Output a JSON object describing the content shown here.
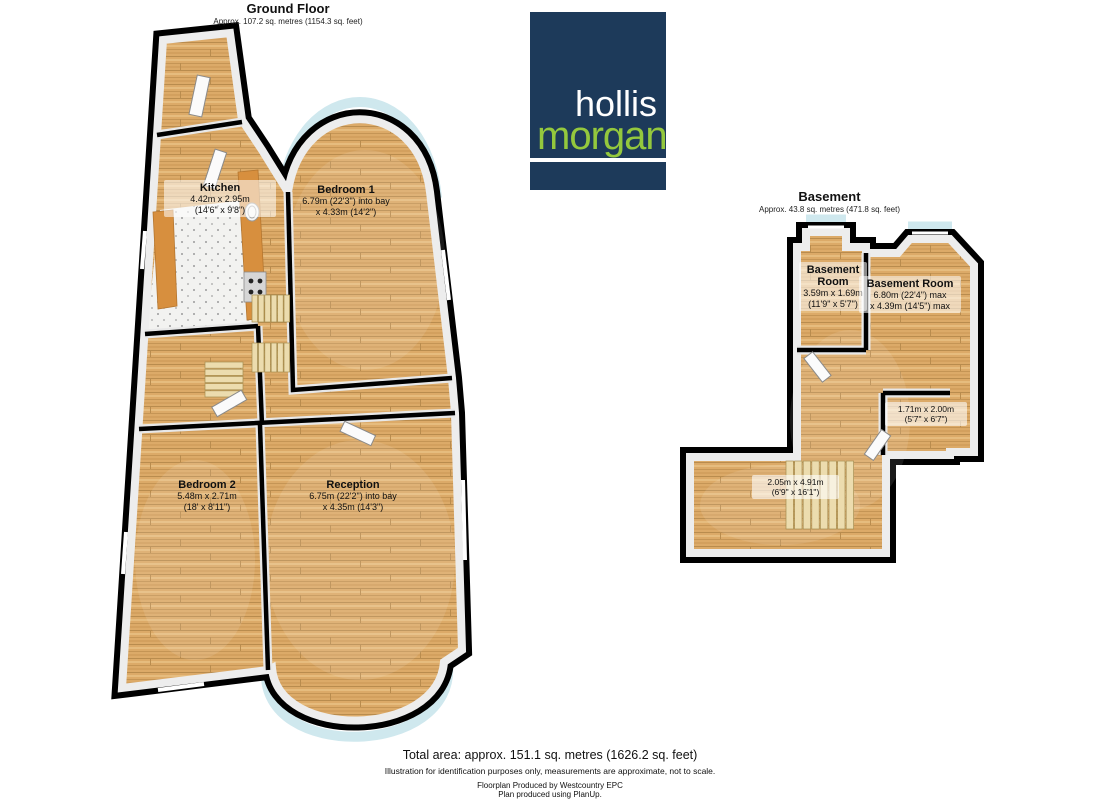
{
  "ground_floor": {
    "title": "Ground Floor",
    "subtitle": "Approx. 107.2 sq. metres (1154.3 sq. feet)",
    "rooms": {
      "kitchen": {
        "name": "Kitchen",
        "metric": "4.42m x 2.95m",
        "imperial": "(14'6\" x 9'8\")"
      },
      "bedroom1": {
        "name": "Bedroom 1",
        "metric": "6.79m (22'3\") into bay",
        "imperial": "x 4.33m (14'2\")"
      },
      "bedroom2": {
        "name": "Bedroom 2",
        "metric": "5.48m x 2.71m",
        "imperial": "(18' x 8'11\")"
      },
      "reception": {
        "name": "Reception",
        "metric": "6.75m (22'2\") into bay",
        "imperial": "x 4.35m (14'3\")"
      }
    }
  },
  "basement": {
    "title": "Basement",
    "subtitle": "Approx.  43.8 sq. metres (471.8 sq. feet)",
    "rooms": {
      "room_left": {
        "name": "Basement Room",
        "metric": "3.59m x 1.69m",
        "imperial": "(11'9\" x 5'7\")"
      },
      "room_right": {
        "name": "Basement Room",
        "metric": "6.80m (22'4\") max",
        "imperial": "x 4.39m (14'5\") max"
      },
      "store": {
        "metric": "1.71m x 2.00m",
        "imperial": "(5'7\" x 6'7\")"
      },
      "lower": {
        "metric": "2.05m x 4.91m",
        "imperial": "(6'9\" x 16'1\")"
      }
    }
  },
  "logo": {
    "word1": "hollis",
    "word2": "morgan",
    "navy": "#1d3a5a",
    "green": "#94c83d"
  },
  "footer": {
    "total": "Total area: approx. 151.1 sq. metres (1626.2 sq. feet)",
    "disclaimer": "Illustration for identification purposes only, measurements are approximate, not to scale.",
    "produced_by": "Floorplan Produced by Westcountry EPC",
    "software": "Plan produced using PlanUp."
  },
  "colors": {
    "wall": "#000000",
    "wall_inner_face": "#ededed",
    "floor_wood": "#dcaa68",
    "window_glass": "#cfe8ee",
    "stair_tread": "#ecdcae"
  }
}
